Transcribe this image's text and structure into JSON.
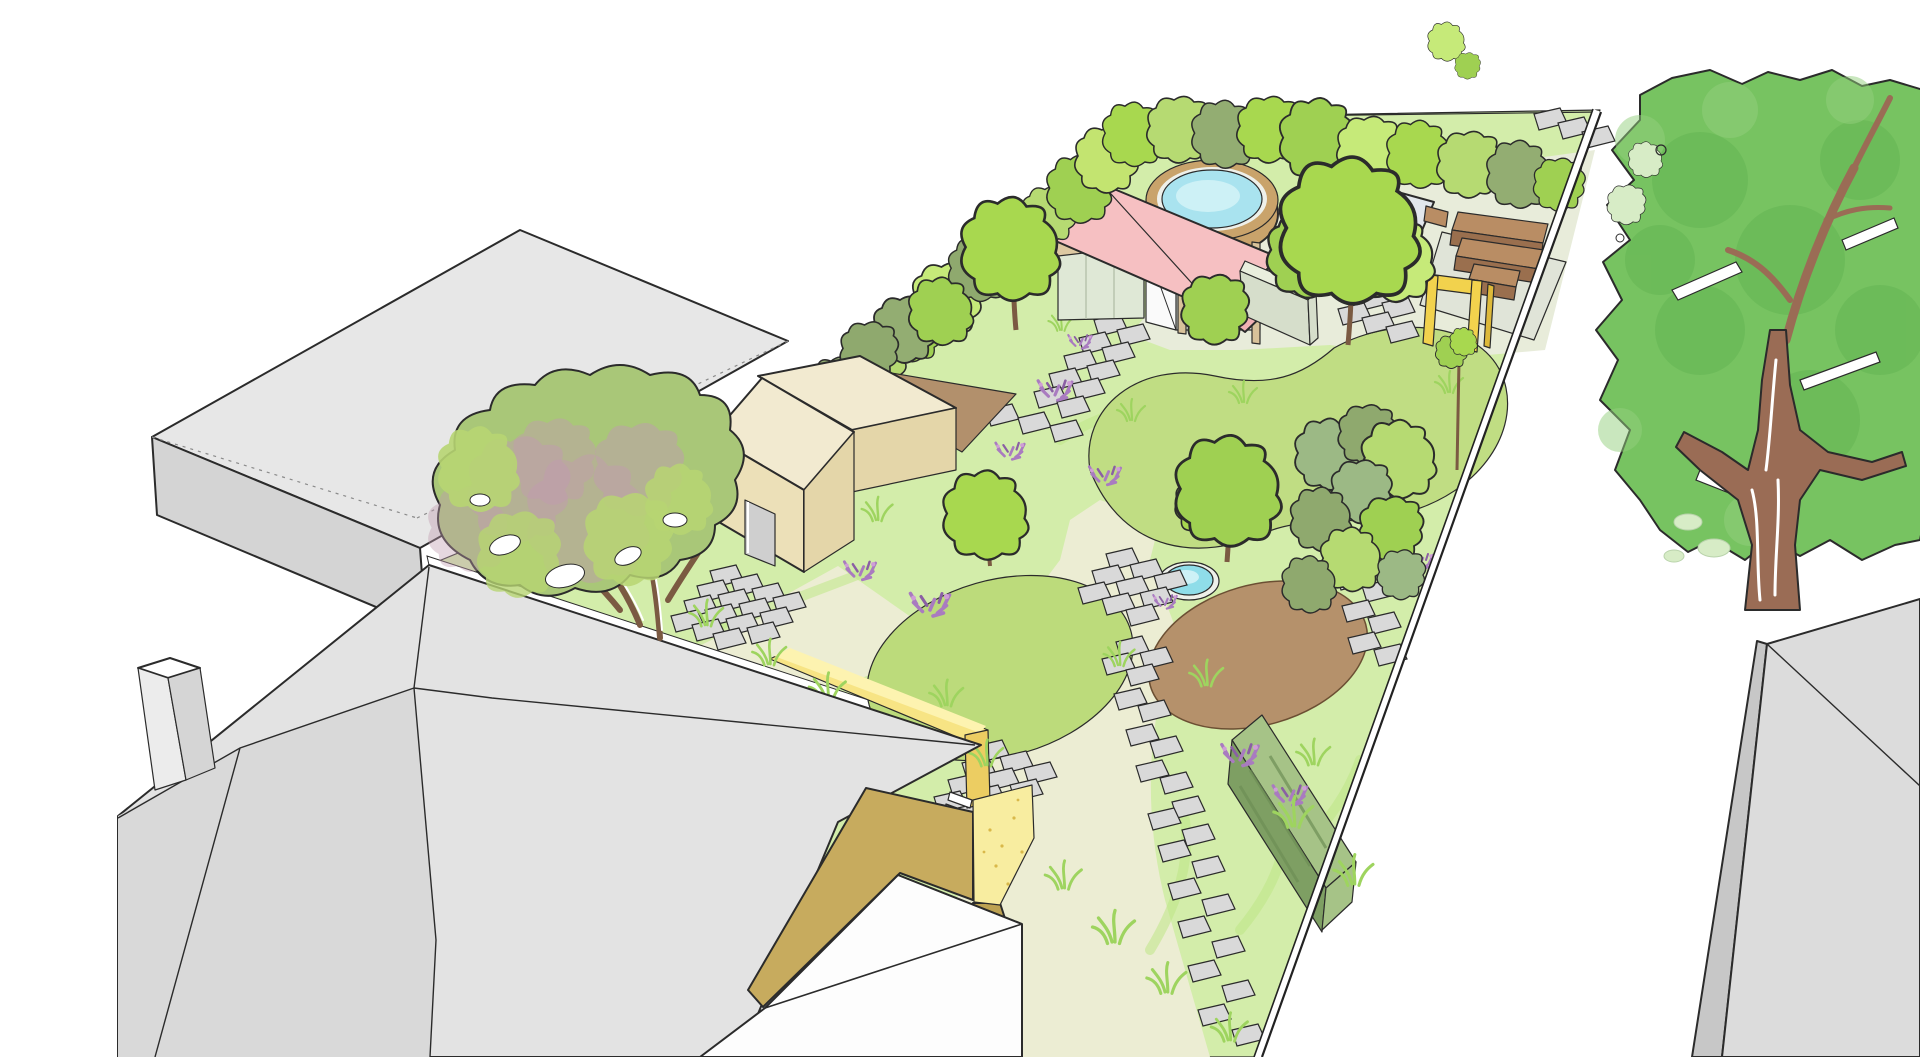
{
  "meta": {
    "title": "3D garden landscape design rendering",
    "render_style": "sketchup-watercolor",
    "view": "aerial axonometric of a long narrow garden plot between neighbouring buildings"
  },
  "palette": {
    "bg": "#ffffff",
    "ink": "#2b2b2b",
    "fence-ink": "#222222",
    "bldg-top": "#e7e7e7",
    "bldg-front": "#d4d4d4",
    "roof-gray": "#e3e3e3",
    "roof-gray-dark": "#d9d9d9",
    "roof-gray-light": "#eeeeee",
    "br-bldg-light": "#dcdcdc",
    "br-bldg-dark": "#c7c7c7",
    "chimney-light": "#ececec",
    "chimney-dark": "#d5d5d5",
    "meadow": "#d3edaa",
    "meadow-bright": "#bfe787",
    "grass-stroke": "#9ed45f",
    "lawn": "#bcdb7b",
    "lawn-kidney": "#c0dd83",
    "path-beige": "#ecedd3",
    "terrace-pale": "#e8ecda",
    "platform-gray": "#e0e4d8",
    "slab": "#d9d9d9",
    "pool-rim": "#c9a36b",
    "pool-rim-dark": "#b68d58",
    "pool-ring": "#eef0ea",
    "water": "#a9e3ef",
    "water-light": "#cdf1f6",
    "pond-water": "#8fdde9",
    "roof-pink": "#f6c0c2",
    "roof-pink-dark": "#f0b0b4",
    "wall-tan": "#ddc9a2",
    "post-tan": "#d8c29a",
    "door-white": "#fafafa",
    "sage-panel": "#dfe8d6",
    "planter-sage": "#d6decb",
    "planter-sage-top": "#e9eedd",
    "veranda-pale": "#eef0e4",
    "shed-roof": "#e2e7ec",
    "shed-wall": "#cdab7e",
    "bed-top": "#b98d64",
    "bed-side": "#9a6f4e",
    "arch-yellow": "#f2d24d",
    "arch-yellow-dark": "#ddb93a",
    "studio-top": "#f2ead0",
    "studio-front": "#ece0b8",
    "studio-side": "#e4d6a9",
    "studio-door": "#cfcfcf",
    "dirt-brown": "#b2906c",
    "brown-circle": "#b5916b",
    "wall-yellow": "#f7e484",
    "wall-yellow-side": "#eccd62",
    "wall-yellow-pale": "#fdf3b0",
    "speckle-yellow": "#d9b84a",
    "hedgebox-top": "#a6c387",
    "hedgebox-front": "#7e9f63",
    "hedgebox-streak": "#6e8f55",
    "khaki": "#c7ab5e",
    "khaki-dark": "#bda252",
    "pale-yellow-wall": "#f8eda0",
    "gable-white": "#fdfdfd",
    "tree-bright": "#a8d84f",
    "tree-mid": "#9fd052",
    "tree-light": "#c6ea79",
    "tree-yellow": "#c3e470",
    "tree-olive": "#93ad72",
    "tree-gray": "#8fa96e",
    "tree-soft": "#b6da72",
    "tree-sage": "#9cb985",
    "mottle-base": "#a9c778",
    "mottle-rose": "#c09bb0",
    "mottle-light": "#b7d572",
    "bigtree": "#77c361",
    "bigtree-dark": "#55a94a",
    "bigtree-light": "#94d07d",
    "leaf-pale": "#d7ecc6",
    "trunk": "#7b5a42",
    "trunk-big": "#9a6c55",
    "flower-purple": "#a97bc0",
    "flower-deep": "#8a5fa4",
    "flower-pink": "#cf9ed6"
  },
  "scene": {
    "elements": [
      {
        "name": "neighbor-building-top-left",
        "label": "flat-roof gray building block"
      },
      {
        "name": "hipped-roof-house",
        "label": "large gray hipped roof house with chimney"
      },
      {
        "name": "khaki-house",
        "label": "dark yellow walled house with white gable roof"
      },
      {
        "name": "neighbor-building-bottom-right",
        "label": "gray building block"
      },
      {
        "name": "garden-plot",
        "label": "long diagonal garden plot"
      },
      {
        "name": "pavilion",
        "label": "garden pavilion with pink gable roof and sage sliding panel"
      },
      {
        "name": "round-pool",
        "label": "raised circular pool with tan rim and blue water"
      },
      {
        "name": "garden-shed",
        "label": "small shed with pale blue roof"
      },
      {
        "name": "raised-beds",
        "label": "three brown raised planter beds"
      },
      {
        "name": "yellow-arch",
        "label": "yellow pergola gate frame"
      },
      {
        "name": "kidney-lawn",
        "label": "kidney shaped lawn"
      },
      {
        "name": "circular-lawn",
        "label": "circular lawn"
      },
      {
        "name": "brown-earth-circle",
        "label": "circular bare earth / gravel area"
      },
      {
        "name": "small-pond",
        "label": "small round pond"
      },
      {
        "name": "garden-studio",
        "label": "two-tier flat roof studio building"
      },
      {
        "name": "yellow-garden-wall",
        "label": "yellow L-shaped garden wall with steps"
      },
      {
        "name": "green-hedge-box",
        "label": "rectangular clipped hedge block"
      },
      {
        "name": "paving",
        "label": "gray paving slab paths and stepping stones"
      },
      {
        "name": "hedgerow",
        "label": "mixed shrub hedgerow along boundary"
      },
      {
        "name": "mottled-tree",
        "label": "large multi-stem blossom tree"
      },
      {
        "name": "big-neighbor-tree",
        "label": "large neighbouring tree with brown trunk"
      },
      {
        "name": "meadow",
        "label": "wildflower meadow with purple accents"
      },
      {
        "name": "boundary-fence",
        "label": "thin boundary fence lines"
      }
    ]
  }
}
